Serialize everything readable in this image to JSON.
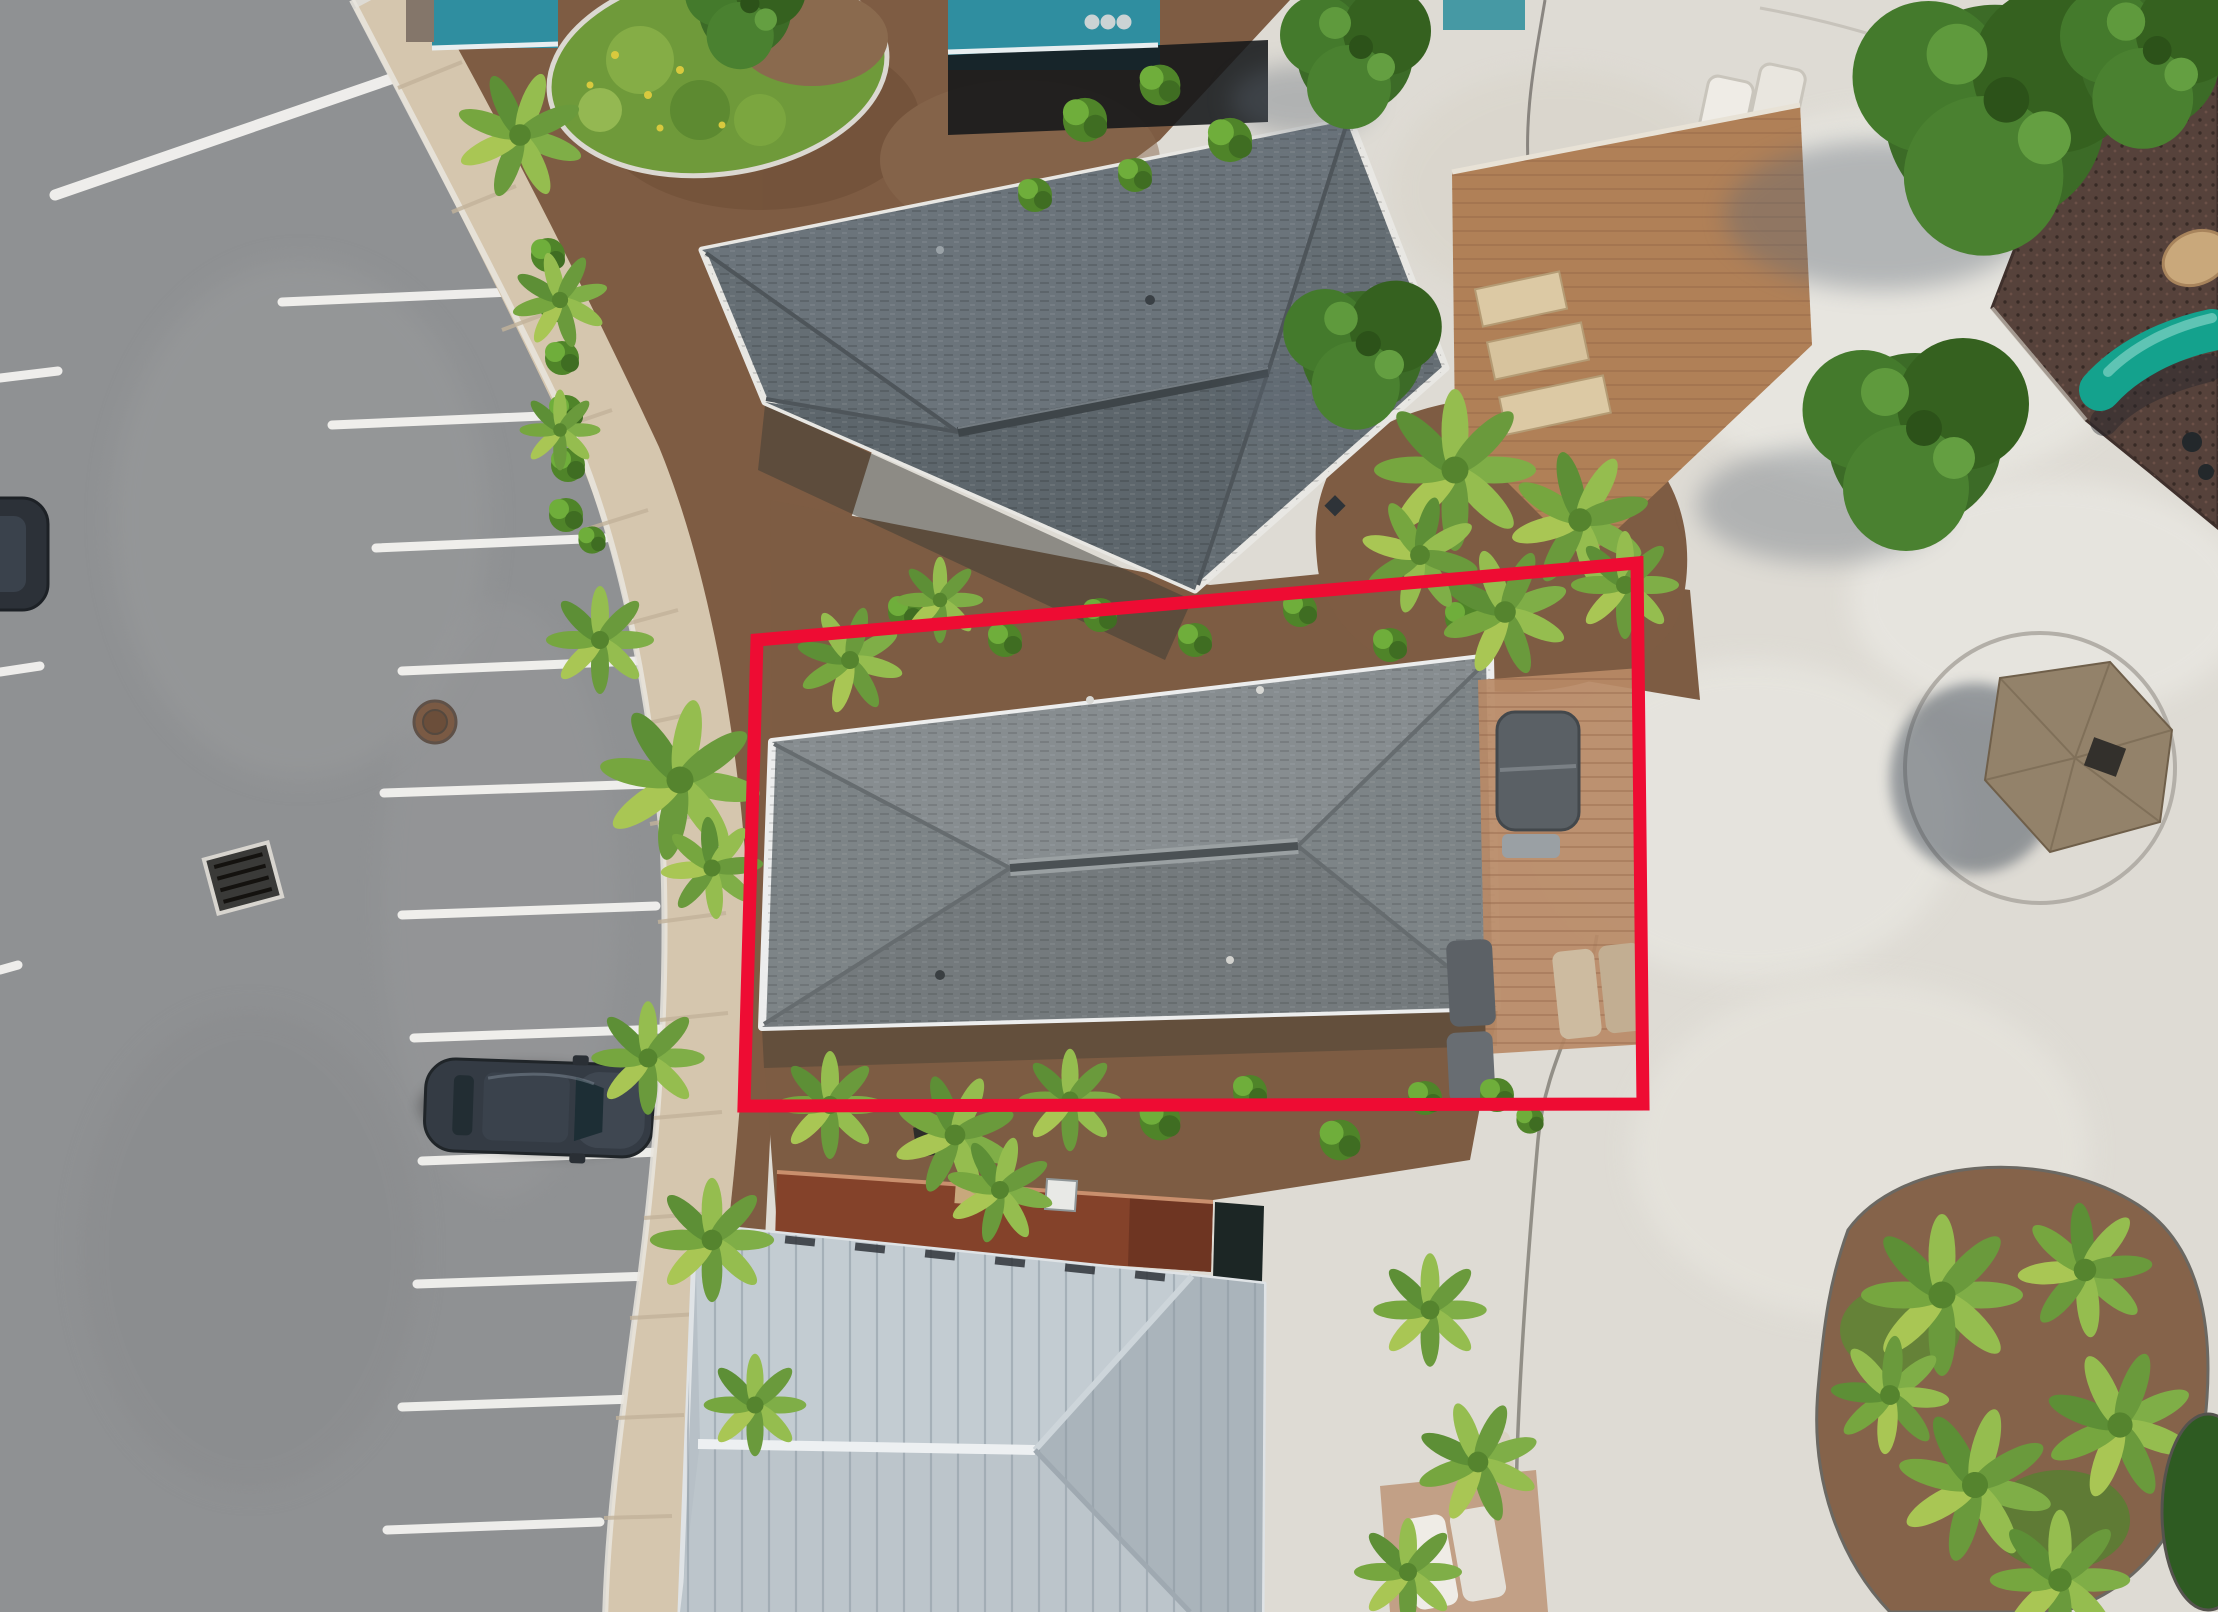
{
  "viewer": {
    "carousel": {
      "dot_count": 3,
      "dots_color": "#d9d9d9"
    }
  },
  "annotation": {
    "property_outline": {
      "shape": "quadrilateral",
      "color": "#ee0c33",
      "stroke_width": 13,
      "points": "757,640 1637,563 1643,1104 744,1106"
    }
  },
  "scene": {
    "type": "aerial-drone-photo",
    "view": "top-down",
    "description": "Top-down drone photo of a coastal community: angled parking along a curved road at left with one parked SUV, a curving sidewalk, three buildings in a row (dark shingle hip roof, gray hip roof outlined in red, light standing-seam metal roof with rust section), mulch and palm landscaping, a concrete plaza at right with a thatched tiki hut, tree canopies and a playground with a teal slide.",
    "objects": [
      "asphalt-road",
      "angled-parking-stripes",
      "parked-suv",
      "edge-parked-car",
      "manhole-cover",
      "storm-drain-grate",
      "sidewalk",
      "landscape-island",
      "teal-building-edge",
      "dark-shingle-roof-building",
      "subject-gray-hip-roof-home",
      "red-property-boundary",
      "rust-metal-roof-section",
      "metal-roof-building",
      "mulch-beds",
      "palm-clusters",
      "shrubs",
      "paver-patio",
      "hot-tub",
      "sun-loungers",
      "paver-steps",
      "concrete-plaza",
      "expansion-joints",
      "thatched-tiki-hut",
      "tree-canopies",
      "playground-rubber-surface",
      "teal-slide",
      "playground-bench",
      "palm-island",
      "carousel-dots"
    ],
    "colors": {
      "asphalt": "#8f9193",
      "concrete": "#dedbd4",
      "sidewalk": "#d5c6ae",
      "mulch": "#7e5c43",
      "stripe_white": "#f3f2ef",
      "roof_top": "#656e74",
      "roof_subject": "#7d8487",
      "metal_roof": "#b7c0c7",
      "rust_roof": "#84422a",
      "teal_wall": "#2f8ea0",
      "playground_surface": "#56423b",
      "slide_teal": "#14a28d",
      "thatch": "#93826a",
      "car_body": "#343b44",
      "tree_green": "#3f7029",
      "palm_green": "#7fae47",
      "bush_green": "#58922f",
      "paver_tan": "#b98a66",
      "grass_island": "#6f9a3a"
    }
  }
}
